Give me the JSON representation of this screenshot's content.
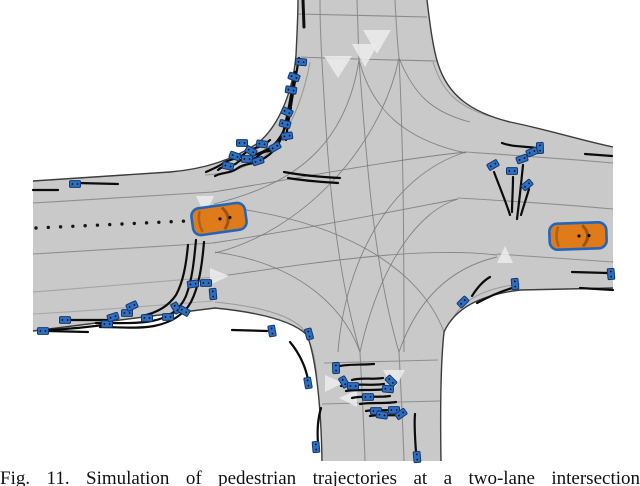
{
  "figure": {
    "caption": "Fig. 11.  Simulation of pedestrian trajectories at a two-lane intersection"
  },
  "colors": {
    "background": "#ffffff",
    "road": "#c9c9c9",
    "edge": "#3c3c3c",
    "lane": "#8f8f8f",
    "guide": "#7b7b7b",
    "arrow": "#ebebeb",
    "trajectory": "#0b0b0b",
    "pedestrian_fill": "#2e6fc0",
    "pedestrian_border": "#14386e",
    "car_body": "#e07b1b",
    "car_outline": "#2565b8",
    "car_dark": "#1d3e66",
    "dot_line": "#151515"
  },
  "scene": {
    "road_outline": "M298,0 L427,0 C430,25 433,48 438,64 C448,95 470,112 510,122 C545,129 580,140 613,147 L613,288 L520,290 C480,295 455,308 444,332 C441,360 440,400 441,461 L322,461 C321,400 315,355 307,335 C292,320 255,312 215,308 L33,331 L33,181 L170,172 C205,169 232,160 258,143 C280,125 293,90 296,55 C297,35 298,15 298,0 Z",
    "edge_lines": [
      {
        "d": "M33,181 L170,172 C205,169 232,160 258,143 C280,125 293,90 296,55 C297,35 298,15 298,0"
      },
      {
        "d": "M427,0 C430,25 433,48 438,64 C448,95 470,112 510,122 C545,129 580,140 613,147"
      },
      {
        "d": "M613,288 L520,290 C480,295 455,308 444,332 C441,360 440,400 441,461"
      },
      {
        "d": "M33,331 L215,308 C255,312 292,320 307,335 C315,355 321,400 322,461"
      }
    ],
    "lane_lines": [
      {
        "d": "M33,203 C100,199 170,195 213,192"
      },
      {
        "d": "M33,254 C100,250 170,246 213,243"
      },
      {
        "d": "M33,292 C100,287 170,281 215,277",
        "c": "#a3a3a3"
      },
      {
        "d": "M33,314 C90,311 160,305 213,301",
        "c": "#a8a8a8"
      },
      {
        "d": "M466,152 C510,155 570,159 613,163"
      },
      {
        "d": "M458,198 C510,201 570,205 613,209"
      },
      {
        "d": "M497,254 C540,257 580,260 613,262"
      },
      {
        "d": "M320,0 C320,25 321,45 322,62"
      },
      {
        "d": "M357,0 L359,60"
      },
      {
        "d": "M395,0 C396,20 397,40 399,58"
      },
      {
        "d": "M298,14 L427,17",
        "c": "#8a8a8a"
      },
      {
        "d": "M301,57 C340,59 400,60 436,61",
        "c": "#8a8a8a"
      },
      {
        "d": "M360,352 C362,390 364,430 365,461"
      },
      {
        "d": "M399,352 C401,390 403,430 404,461"
      },
      {
        "d": "M324,363 L438,360"
      },
      {
        "d": "M322,404 L440,401"
      },
      {
        "d": "M310,62 C303,100 288,138 264,156 C245,169 225,174 205,175",
        "c": "#9a9a9a"
      },
      {
        "d": "M433,62 C443,95 462,110 500,119",
        "c": "#9a9a9a"
      },
      {
        "d": "M215,302 C255,306 288,314 302,328 C312,342 316,360 317,380",
        "c": "#9a9a9a"
      },
      {
        "d": "M520,284 C485,288 462,300 452,320",
        "c": "#9e9e9e"
      }
    ],
    "guide_lines": [
      {
        "d": "M213,192 C300,178 390,160 466,152"
      },
      {
        "d": "M213,243 C310,228 390,212 458,199"
      },
      {
        "d": "M215,277 C320,262 420,246 497,255"
      },
      {
        "d": "M322,62 C328,170 334,260 360,352"
      },
      {
        "d": "M359,60 C368,180 375,270 399,352"
      },
      {
        "d": "M399,58 C403,140 404,220 404,352"
      },
      {
        "d": "M359,60 C345,150 290,185 214,204"
      },
      {
        "d": "M359,60 C372,110 405,140 466,153"
      },
      {
        "d": "M399,58 C414,95 432,112 470,122"
      },
      {
        "d": "M360,352 C340,298 288,262 215,252"
      },
      {
        "d": "M399,352 C417,300 450,268 497,257"
      },
      {
        "d": "M214,206 C340,218 420,268 444,332"
      },
      {
        "d": "M466,152 C390,175 345,262 338,352"
      },
      {
        "d": "M399,58 C380,150 300,232 215,253"
      },
      {
        "d": "M360,352 C380,262 420,210 458,199"
      }
    ],
    "center_dotted": {
      "x1": 36,
      "y1": 228,
      "x2": 208,
      "y2": 220,
      "count": 15,
      "r": 1.7
    },
    "arrows": [
      [
        [
          363,
          30
        ],
        [
          391,
          30
        ],
        [
          377,
          54
        ]
      ],
      [
        [
          352,
          44
        ],
        [
          378,
          44
        ],
        [
          365,
          67
        ]
      ],
      [
        [
          324,
          56
        ],
        [
          352,
          56
        ],
        [
          338,
          78
        ]
      ],
      [
        [
          196,
          196
        ],
        [
          214,
          196
        ],
        [
          205,
          215
        ]
      ],
      [
        [
          210,
          268
        ],
        [
          210,
          285
        ],
        [
          229,
          276
        ]
      ],
      [
        [
          497,
          263
        ],
        [
          513,
          263
        ],
        [
          505,
          246
        ]
      ],
      [
        [
          325,
          375
        ],
        [
          325,
          392
        ],
        [
          343,
          383
        ]
      ],
      [
        [
          357,
          390
        ],
        [
          357,
          407
        ],
        [
          339,
          398
        ]
      ],
      [
        [
          383,
          370
        ],
        [
          405,
          370
        ],
        [
          394,
          390
        ]
      ]
    ],
    "trajectories": [
      {
        "d": "M303,0 L304,27",
        "w": 3
      },
      {
        "d": "M299,58 C295,80 292,100 289,118 C287,128 287,134 286,140"
      },
      {
        "d": "M295,72 C291,95 288,115 283,133 C279,146 271,155 261,160"
      },
      {
        "d": "M291,108 C287,126 281,140 270,148 C260,154 250,156 243,160"
      },
      {
        "d": "M280,146 C272,154 266,148 258,156 C252,162 244,156 238,162 C232,168 224,164 218,170"
      },
      {
        "d": "M270,140 C260,150 252,146 244,154 C238,160 230,158 222,164 C216,168 210,170 206,172"
      },
      {
        "d": "M262,158 C254,166 246,162 238,168 C230,174 222,172 215,176"
      },
      {
        "d": "M284,172 C300,175 320,177 340,178"
      },
      {
        "d": "M288,178 C305,181 322,182 338,183"
      },
      {
        "d": "M78,183 L118,184"
      },
      {
        "d": "M33,190 L58,190"
      },
      {
        "d": "M196,240 C194,262 192,280 186,296 C180,310 168,318 152,321 C135,324 115,323 96,323"
      },
      {
        "d": "M204,242 C202,266 199,286 191,302 C184,315 170,323 154,326 C138,329 118,327 100,327"
      },
      {
        "d": "M188,245 C186,266 183,282 176,295 C168,307 156,313 142,316"
      },
      {
        "d": "M110,324 C90,327 70,329 48,330"
      },
      {
        "d": "M48,331 L88,332"
      },
      {
        "d": "M68,320 L108,320"
      },
      {
        "d": "M232,330 L267,331"
      },
      {
        "d": "M494,172 C500,188 506,202 510,215"
      },
      {
        "d": "M513,177 C513,190 512,202 512,212"
      },
      {
        "d": "M523,165 C521,185 519,203 517,219"
      },
      {
        "d": "M529,189 C526,199 523,208 521,215"
      },
      {
        "d": "M502,143 C512,147 524,146 536,148"
      },
      {
        "d": "M585,154 L612,156"
      },
      {
        "d": "M572,272 L608,273"
      },
      {
        "d": "M580,288 L613,290"
      },
      {
        "d": "M472,296 C477,288 483,281 490,277"
      },
      {
        "d": "M477,303 C490,296 504,290 516,287"
      },
      {
        "d": "M340,366 C350,364 362,365 374,364"
      },
      {
        "d": "M352,380 C362,377 372,380 383,378"
      },
      {
        "d": "M341,386 C355,383 368,386 384,384"
      },
      {
        "d": "M346,391 C358,389 372,391 387,389"
      },
      {
        "d": "M352,398 C364,395 377,398 390,396"
      },
      {
        "d": "M360,404 C372,402 384,404 396,402"
      },
      {
        "d": "M366,411 C376,409 386,411 395,410"
      },
      {
        "d": "M370,416 C380,414 390,416 400,415"
      },
      {
        "d": "M290,342 C300,354 306,368 308,380"
      },
      {
        "d": "M318,443 C317,430 318,418 321,408"
      },
      {
        "d": "M416,452 C415,438 414,425 415,414"
      }
    ],
    "pedestrians": [
      {
        "x": 301,
        "y": 62,
        "r": 5
      },
      {
        "x": 294,
        "y": 77,
        "r": 20
      },
      {
        "x": 291,
        "y": 90,
        "r": 10
      },
      {
        "x": 287,
        "y": 112,
        "r": 25
      },
      {
        "x": 285,
        "y": 124,
        "r": 15
      },
      {
        "x": 287,
        "y": 136,
        "r": -8
      },
      {
        "x": 275,
        "y": 147,
        "r": -30
      },
      {
        "x": 262,
        "y": 144,
        "r": 8
      },
      {
        "x": 251,
        "y": 151,
        "r": 30
      },
      {
        "x": 242,
        "y": 143,
        "r": 0
      },
      {
        "x": 235,
        "y": 156,
        "r": 20
      },
      {
        "x": 247,
        "y": 159,
        "r": 0
      },
      {
        "x": 258,
        "y": 161,
        "r": -18
      },
      {
        "x": 228,
        "y": 166,
        "r": 12
      },
      {
        "x": 75,
        "y": 184,
        "r": 0
      },
      {
        "x": 43,
        "y": 331,
        "r": 0
      },
      {
        "x": 65,
        "y": 320,
        "r": 0
      },
      {
        "x": 107,
        "y": 324,
        "r": 0
      },
      {
        "x": 113,
        "y": 317,
        "r": -18
      },
      {
        "x": 127,
        "y": 313,
        "r": 0
      },
      {
        "x": 132,
        "y": 306,
        "r": -25
      },
      {
        "x": 147,
        "y": 318,
        "r": 0
      },
      {
        "x": 168,
        "y": 317,
        "r": 0
      },
      {
        "x": 176,
        "y": 308,
        "r": 60
      },
      {
        "x": 184,
        "y": 311,
        "r": 30
      },
      {
        "x": 193,
        "y": 284,
        "r": -8
      },
      {
        "x": 206,
        "y": 283,
        "r": 0
      },
      {
        "x": 213,
        "y": 294,
        "r": 85
      },
      {
        "x": 272,
        "y": 331,
        "r": 80
      },
      {
        "x": 309,
        "y": 334,
        "r": 75
      },
      {
        "x": 336,
        "y": 368,
        "r": 88
      },
      {
        "x": 344,
        "y": 382,
        "r": 60
      },
      {
        "x": 353,
        "y": 386,
        "r": 0
      },
      {
        "x": 391,
        "y": 381,
        "r": 45
      },
      {
        "x": 388,
        "y": 389,
        "r": 5
      },
      {
        "x": 368,
        "y": 397,
        "r": 0
      },
      {
        "x": 376,
        "y": 411,
        "r": 0
      },
      {
        "x": 382,
        "y": 415,
        "r": 8
      },
      {
        "x": 394,
        "y": 410,
        "r": 0
      },
      {
        "x": 401,
        "y": 414,
        "r": -35
      },
      {
        "x": 308,
        "y": 383,
        "r": 80
      },
      {
        "x": 316,
        "y": 447,
        "r": 85
      },
      {
        "x": 417,
        "y": 457,
        "r": 85
      },
      {
        "x": 540,
        "y": 148,
        "r": 88
      },
      {
        "x": 493,
        "y": 165,
        "r": -30
      },
      {
        "x": 522,
        "y": 159,
        "r": -20
      },
      {
        "x": 512,
        "y": 171,
        "r": 0
      },
      {
        "x": 527,
        "y": 185,
        "r": -40
      },
      {
        "x": 532,
        "y": 152,
        "r": -22
      },
      {
        "x": 463,
        "y": 302,
        "r": -45
      },
      {
        "x": 515,
        "y": 284,
        "r": 85
      },
      {
        "x": 611,
        "y": 274,
        "r": 85
      }
    ],
    "vehicles": [
      {
        "x": 219,
        "y": 219,
        "len": 54,
        "wid": 27,
        "angle": -8
      },
      {
        "x": 578,
        "y": 236,
        "len": 57,
        "wid": 26,
        "angle": -2
      }
    ]
  }
}
